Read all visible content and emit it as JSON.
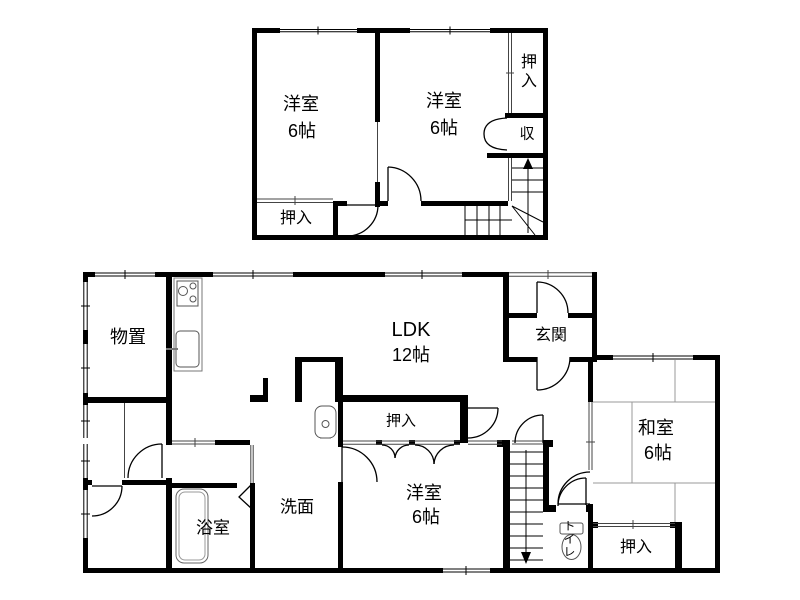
{
  "colors": {
    "wall": "#000000",
    "fixture": "#555555",
    "tatami": "#999999",
    "background": "#ffffff"
  },
  "floor2": {
    "room_west": {
      "name": "洋室",
      "size": "6帖"
    },
    "room_east": {
      "name": "洋室",
      "size": "6帖"
    },
    "closet_ne": "押入",
    "storage_shu": "収",
    "closet_sw": "押入"
  },
  "floor1": {
    "storage": "物置",
    "ldk": {
      "name": "LDK",
      "size": "12帖"
    },
    "entrance": "玄関",
    "japanese_room": {
      "name": "和室",
      "size": "6帖"
    },
    "closet_se": "押入",
    "toilet": "トイレ",
    "closet_center": "押入",
    "western_room": {
      "name": "洋室",
      "size": "6帖"
    },
    "washroom": "洗面",
    "bathroom": "浴室"
  }
}
